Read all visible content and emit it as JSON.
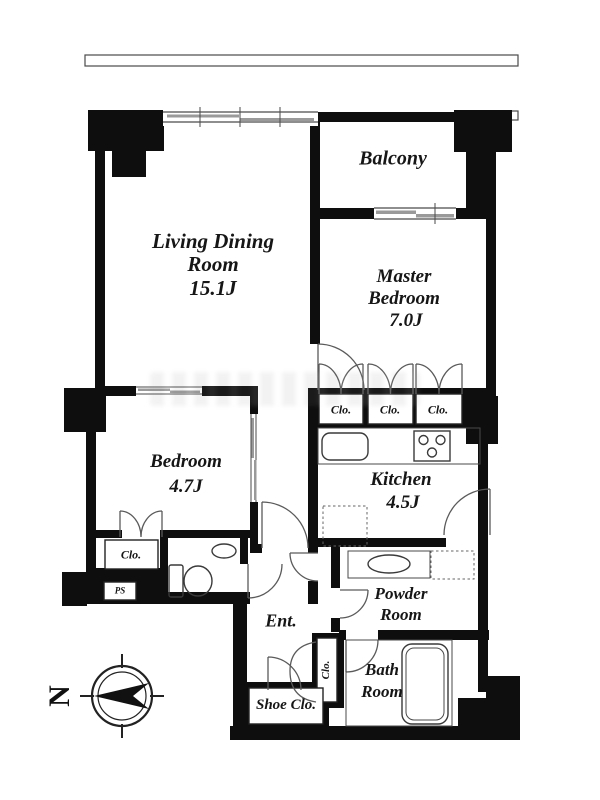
{
  "plan_type": "apartment-floor-plan",
  "rooms": {
    "balcony": {
      "label": "Balcony"
    },
    "living_dining": {
      "line1": "Living Dining",
      "line2": "Room",
      "size": "15.1J"
    },
    "master_bedroom": {
      "line1": "Master",
      "line2": "Bedroom",
      "size": "7.0J"
    },
    "bedroom": {
      "line1": "Bedroom",
      "size": "4.7J"
    },
    "kitchen": {
      "line1": "Kitchen",
      "size": "4.5J"
    },
    "powder_room": {
      "line1": "Powder",
      "line2": "Room"
    },
    "bath_room": {
      "line1": "Bath",
      "line2": "Room"
    },
    "entrance": {
      "label": "Ent."
    },
    "shoe_closet": {
      "label": "Shoe Clo."
    }
  },
  "closets": {
    "master_clo_1": "Clo.",
    "master_clo_2": "Clo.",
    "master_clo_3": "Clo.",
    "bedroom_clo": "Clo.",
    "hall_clo": "Clo."
  },
  "utility": {
    "pipe_space": "PS"
  },
  "compass": {
    "north": "N"
  },
  "colors": {
    "wall": "#0e0e0e",
    "line": "#3a3a3a",
    "sliding_door": "#9a9a9a",
    "background": "#ffffff"
  }
}
